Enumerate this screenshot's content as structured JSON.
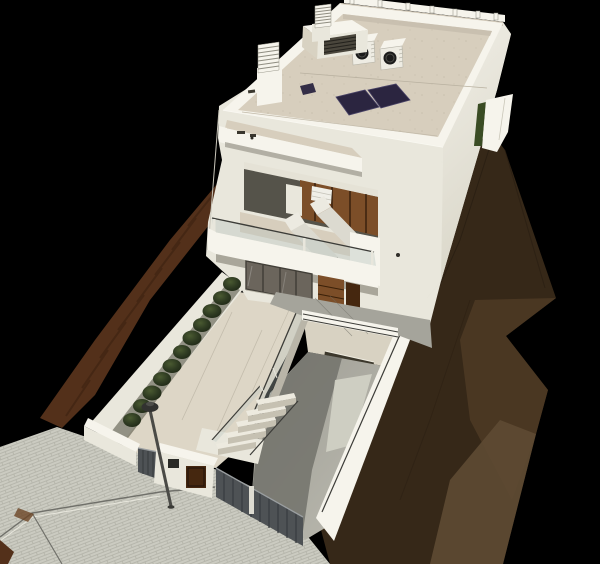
{
  "scene": {
    "title": "Aerial 3D architectural rendering of a modern two-storey white house on a hillside plot",
    "background": "black",
    "objects": {
      "hillside_terrain": "Brown hillside terrain",
      "neighbor_slope": "Neighbouring sloped ground strip",
      "street_pavement": "Paved street with brick pattern",
      "street_lamp": "Street lamp",
      "front_courtyard": "Front courtyard terrace",
      "planter_shrubs": "Row of shrubs along boundary planter",
      "entry_gate": "Entrance fence and gate",
      "mailbox_pillar": "Gate pillar with letterbox panel",
      "entry_stairs": "Outdoor entry staircase with glass railing",
      "driveway_ramp": "Sunken driveway ramp to basement garage",
      "garage_opening": "Garage opening at ramp end",
      "house": "Two-storey modern white house",
      "roof_terrace": "Flat roof terrace with parapet",
      "solar_panels": "Rooftop solar panels",
      "ac_units": "Rooftop air-conditioning units",
      "roof_bulkhead": "Roof bulkhead with louvre vent",
      "chimneys": "Ventilation chimneys",
      "balcony": "First-floor recessed balcony",
      "sun_loungers": "Two sun loungers on balcony",
      "balcony_railing": "Glass balcony railing",
      "sliding_glass_doors": "Ground-floor sliding glass doors",
      "entry_door": "Wooden entrance door",
      "entrance_porch": "Grey tiled entrance porch",
      "side_boundary_wall": "Side boundary wall with hedge"
    },
    "counts": {
      "solar_panels": 3,
      "ac_units": 2,
      "sun_loungers": 2,
      "stair_treads": 5,
      "shrubs": 11,
      "chimneys": 2
    }
  },
  "colors": {
    "background": "#000000",
    "wall": "#e9e7dc",
    "wall_bright": "#f6f4ec",
    "wall_shade": "#d8d2c2",
    "roof_deck": "#d7cebd",
    "terrace": "#ddd6c6",
    "porch": "#a5a49b",
    "concrete": "#a9a8a0",
    "concrete_shadow": "#72726b",
    "concrete_bright": "#d2d1c5",
    "street": "#cbcbc1",
    "street_line": "#a6a69b",
    "terrain_dark": "#362818",
    "terrain_mid": "#4e3a25",
    "terrain_light": "#5e4a33",
    "terrain_red": "#53301a",
    "bush": "#2f3b22",
    "bush_dark": "#1e2715",
    "hedge": "#3a4c24",
    "wood": "#7c4e28",
    "wood_dark": "#45270f",
    "solar_panel": "#2b2540",
    "glass": "#b9c6c0",
    "railing": "#3c3c38",
    "fence": "#4e5255",
    "fence_slat": "#3a3e41",
    "lamp": "#3a3a36",
    "ac_fan": "#1b1b1b",
    "shadow": "#8d8a7e"
  }
}
